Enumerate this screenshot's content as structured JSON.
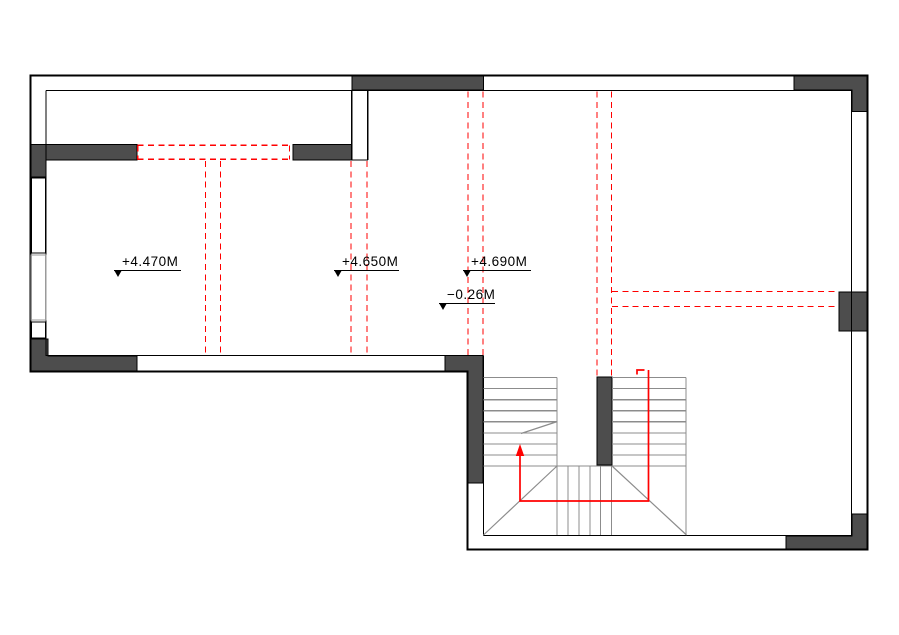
{
  "document": {
    "kind": "architectural floor plan",
    "background": "#ffffff"
  },
  "colors": {
    "wall_outline": "#000000",
    "wall_fill": "#4d4d4d",
    "stair_lines": "#8c8c8c",
    "window_lines": "#9a9a9a",
    "annotation_red": "#ff0000",
    "text": "#000000"
  },
  "level_markers": [
    {
      "label": "+4.470M",
      "symbol": "datum-triangle-icon"
    },
    {
      "label": "+4.650M",
      "symbol": "datum-triangle-icon"
    },
    {
      "label": "+4.690M",
      "symbol": "datum-triangle-icon"
    },
    {
      "label": "−0.26M",
      "symbol": "datum-triangle-icon"
    }
  ],
  "stair": {
    "up_arrow": true,
    "treads_left_flight": 8,
    "treads_right_flight": 8,
    "winder_lines": 6
  }
}
